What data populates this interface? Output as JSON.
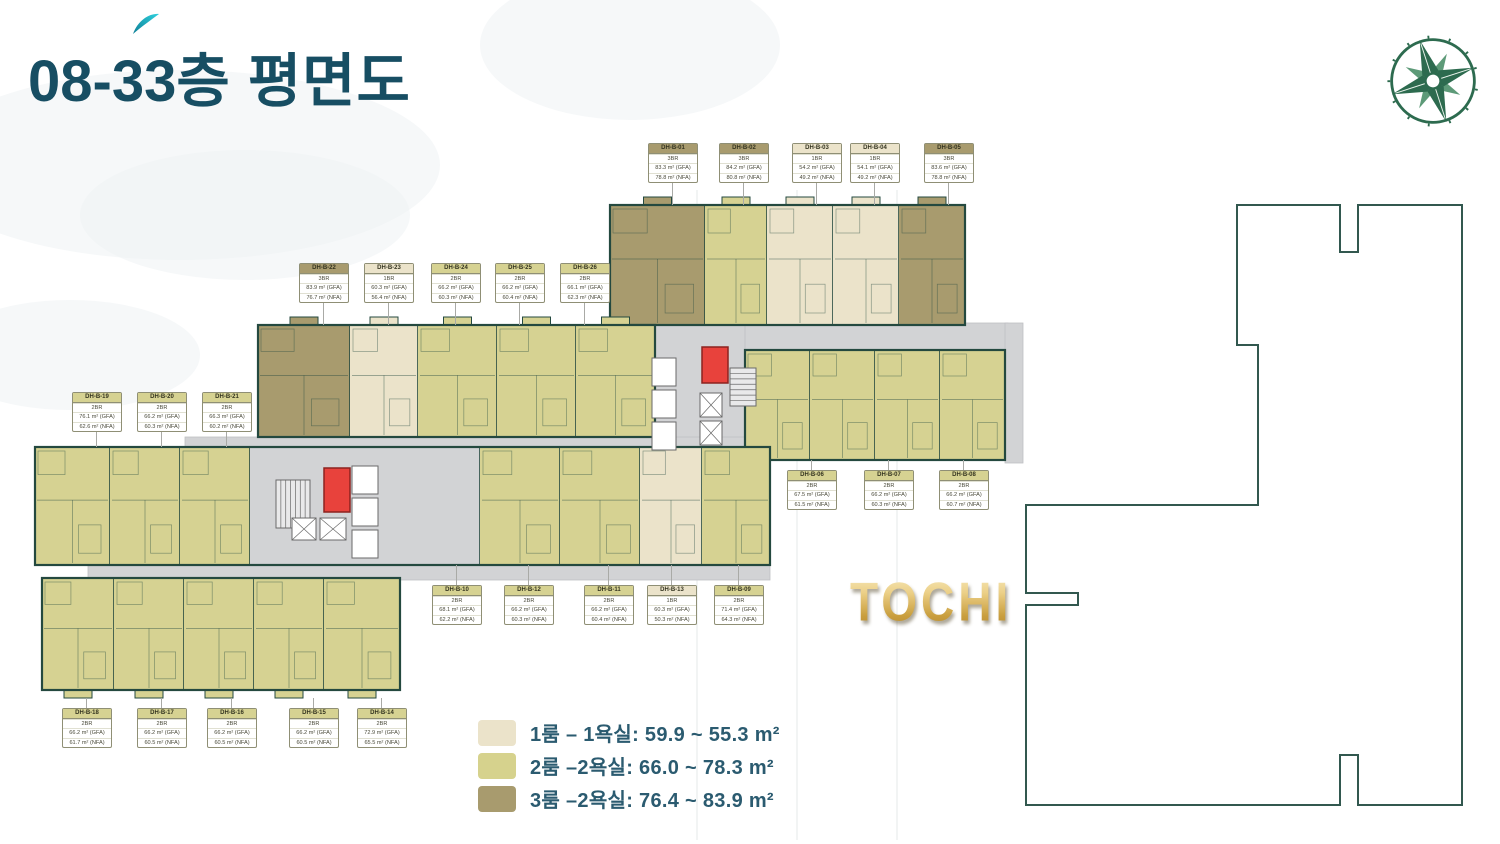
{
  "title": {
    "number": "08-33",
    "suffix": "층 평면도"
  },
  "watermark": "TOCHI",
  "logo": {
    "name": "compass-logo"
  },
  "legend": {
    "items": [
      {
        "color": "#ebe3ca",
        "label": "1룸 – 1욕실:",
        "value": "59.9 ~ 55.3 m²"
      },
      {
        "color": "#d6d28d",
        "label": "2룸 –2욕실:",
        "value": "66.0 ~ 78.3 m²"
      },
      {
        "color": "#a89b6e",
        "label": "3룸 –2욕실:",
        "value": "76.4 ~ 83.9 m²"
      }
    ]
  },
  "colors": {
    "unit_1br": "#ebe3ca",
    "unit_2br": "#d6d292",
    "unit_3br": "#a89b6e",
    "corridor": "#d2d3d5",
    "wall": "#24493f",
    "highlight_red": "#e8423c",
    "title_text": "#174e63",
    "legend_text": "#2b5b70",
    "accent_teal": "#1cb8c9",
    "gold": "#c9a23f",
    "logo_green": "#2d6b4f"
  },
  "units": [
    {
      "id": "DH-B-01",
      "br": "3BR",
      "gfa": "83.3 m² (GFA)",
      "nfa": "78.8 m² (NFA)",
      "type": "3br",
      "x": 648,
      "y": 143,
      "leader": "down",
      "llen": 26
    },
    {
      "id": "DH-B-02",
      "br": "3BR",
      "gfa": "84.2 m² (GFA)",
      "nfa": "80.8 m² (NFA)",
      "type": "3br",
      "x": 719,
      "y": 143,
      "leader": "down",
      "llen": 26
    },
    {
      "id": "DH-B-03",
      "br": "1BR",
      "gfa": "54.2 m² (GFA)",
      "nfa": "49.2 m² (NFA)",
      "type": "1br",
      "x": 792,
      "y": 143,
      "leader": "down",
      "llen": 26
    },
    {
      "id": "DH-B-04",
      "br": "1BR",
      "gfa": "54.1 m² (GFA)",
      "nfa": "49.2 m² (NFA)",
      "type": "1br",
      "x": 850,
      "y": 143,
      "leader": "down",
      "llen": 26
    },
    {
      "id": "DH-B-05",
      "br": "3BR",
      "gfa": "83.6 m² (GFA)",
      "nfa": "78.8 m² (NFA)",
      "type": "3br",
      "x": 924,
      "y": 143,
      "leader": "down",
      "llen": 26
    },
    {
      "id": "DH-B-22",
      "br": "3BR",
      "gfa": "83.9 m² (GFA)",
      "nfa": "76.7 m² (NFA)",
      "type": "3br",
      "x": 299,
      "y": 263,
      "leader": "down",
      "llen": 26
    },
    {
      "id": "DH-B-23",
      "br": "1BR",
      "gfa": "60.3 m² (GFA)",
      "nfa": "56.4 m² (NFA)",
      "type": "1br",
      "x": 364,
      "y": 263,
      "leader": "down",
      "llen": 26
    },
    {
      "id": "DH-B-24",
      "br": "2BR",
      "gfa": "66.2 m² (GFA)",
      "nfa": "60.3 m² (NFA)",
      "type": "2br",
      "x": 431,
      "y": 263,
      "leader": "down",
      "llen": 26
    },
    {
      "id": "DH-B-25",
      "br": "2BR",
      "gfa": "66.2 m² (GFA)",
      "nfa": "60.4 m² (NFA)",
      "type": "2br",
      "x": 495,
      "y": 263,
      "leader": "down",
      "llen": 26
    },
    {
      "id": "DH-B-26",
      "br": "2BR",
      "gfa": "66.1 m² (GFA)",
      "nfa": "62.3 m² (NFA)",
      "type": "2br",
      "x": 560,
      "y": 263,
      "leader": "down",
      "llen": 26
    },
    {
      "id": "DH-B-19",
      "br": "2BR",
      "gfa": "76.1 m² (GFA)",
      "nfa": "62.6 m² (NFA)",
      "type": "2br",
      "x": 72,
      "y": 392,
      "leader": "down",
      "llen": 19
    },
    {
      "id": "DH-B-20",
      "br": "2BR",
      "gfa": "66.2 m² (GFA)",
      "nfa": "60.3 m² (NFA)",
      "type": "2br",
      "x": 137,
      "y": 392,
      "leader": "down",
      "llen": 19
    },
    {
      "id": "DH-B-21",
      "br": "2BR",
      "gfa": "66.3 m² (GFA)",
      "nfa": "60.2 m² (NFA)",
      "type": "2br",
      "x": 202,
      "y": 392,
      "leader": "down",
      "llen": 19
    },
    {
      "id": "DH-B-06",
      "br": "2BR",
      "gfa": "67.5 m² (GFA)",
      "nfa": "61.5 m² (NFA)",
      "type": "2br",
      "x": 787,
      "y": 470,
      "leader": "up",
      "llen": 10
    },
    {
      "id": "DH-B-07",
      "br": "2BR",
      "gfa": "66.2 m² (GFA)",
      "nfa": "60.3 m² (NFA)",
      "type": "2br",
      "x": 864,
      "y": 470,
      "leader": "up",
      "llen": 10
    },
    {
      "id": "DH-B-08",
      "br": "2BR",
      "gfa": "66.2 m² (GFA)",
      "nfa": "60.7 m² (NFA)",
      "type": "2br",
      "x": 939,
      "y": 470,
      "leader": "up",
      "llen": 10
    },
    {
      "id": "DH-B-10",
      "br": "2BR",
      "gfa": "68.1 m² (GFA)",
      "nfa": "62.2 m² (NFA)",
      "type": "2br",
      "x": 432,
      "y": 585,
      "leader": "up",
      "llen": 20
    },
    {
      "id": "DH-B-12",
      "br": "2BR",
      "gfa": "66.2 m² (GFA)",
      "nfa": "60.3 m² (NFA)",
      "type": "2br",
      "x": 504,
      "y": 585,
      "leader": "up",
      "llen": 20
    },
    {
      "id": "DH-B-11",
      "br": "2BR",
      "gfa": "66.2 m² (GFA)",
      "nfa": "60.4 m² (NFA)",
      "type": "2br",
      "x": 584,
      "y": 585,
      "leader": "up",
      "llen": 20
    },
    {
      "id": "DH-B-13",
      "br": "1BR",
      "gfa": "60.3 m² (GFA)",
      "nfa": "50.3 m² (NFA)",
      "type": "1br",
      "x": 647,
      "y": 585,
      "leader": "up",
      "llen": 20
    },
    {
      "id": "DH-B-09",
      "br": "2BR",
      "gfa": "71.4 m² (GFA)",
      "nfa": "64.3 m² (NFA)",
      "type": "2br",
      "x": 714,
      "y": 585,
      "leader": "up",
      "llen": 20
    },
    {
      "id": "DH-B-18",
      "br": "2BR",
      "gfa": "66.2 m² (GFA)",
      "nfa": "61.7 m² (NFA)",
      "type": "2br",
      "x": 62,
      "y": 708,
      "leader": "up",
      "llen": 10
    },
    {
      "id": "DH-B-17",
      "br": "2BR",
      "gfa": "66.2 m² (GFA)",
      "nfa": "60.5 m² (NFA)",
      "type": "2br",
      "x": 137,
      "y": 708,
      "leader": "up",
      "llen": 10
    },
    {
      "id": "DH-B-16",
      "br": "2BR",
      "gfa": "66.2 m² (GFA)",
      "nfa": "60.5 m² (NFA)",
      "type": "2br",
      "x": 207,
      "y": 708,
      "leader": "up",
      "llen": 10
    },
    {
      "id": "DH-B-15",
      "br": "2BR",
      "gfa": "66.2 m² (GFA)",
      "nfa": "60.5 m² (NFA)",
      "type": "2br",
      "x": 289,
      "y": 708,
      "leader": "up",
      "llen": 10
    },
    {
      "id": "DH-B-14",
      "br": "2BR",
      "gfa": "72.9 m² (GFA)",
      "nfa": "65.5 m² (NFA)",
      "type": "2br",
      "x": 357,
      "y": 708,
      "leader": "up",
      "llen": 10
    }
  ]
}
